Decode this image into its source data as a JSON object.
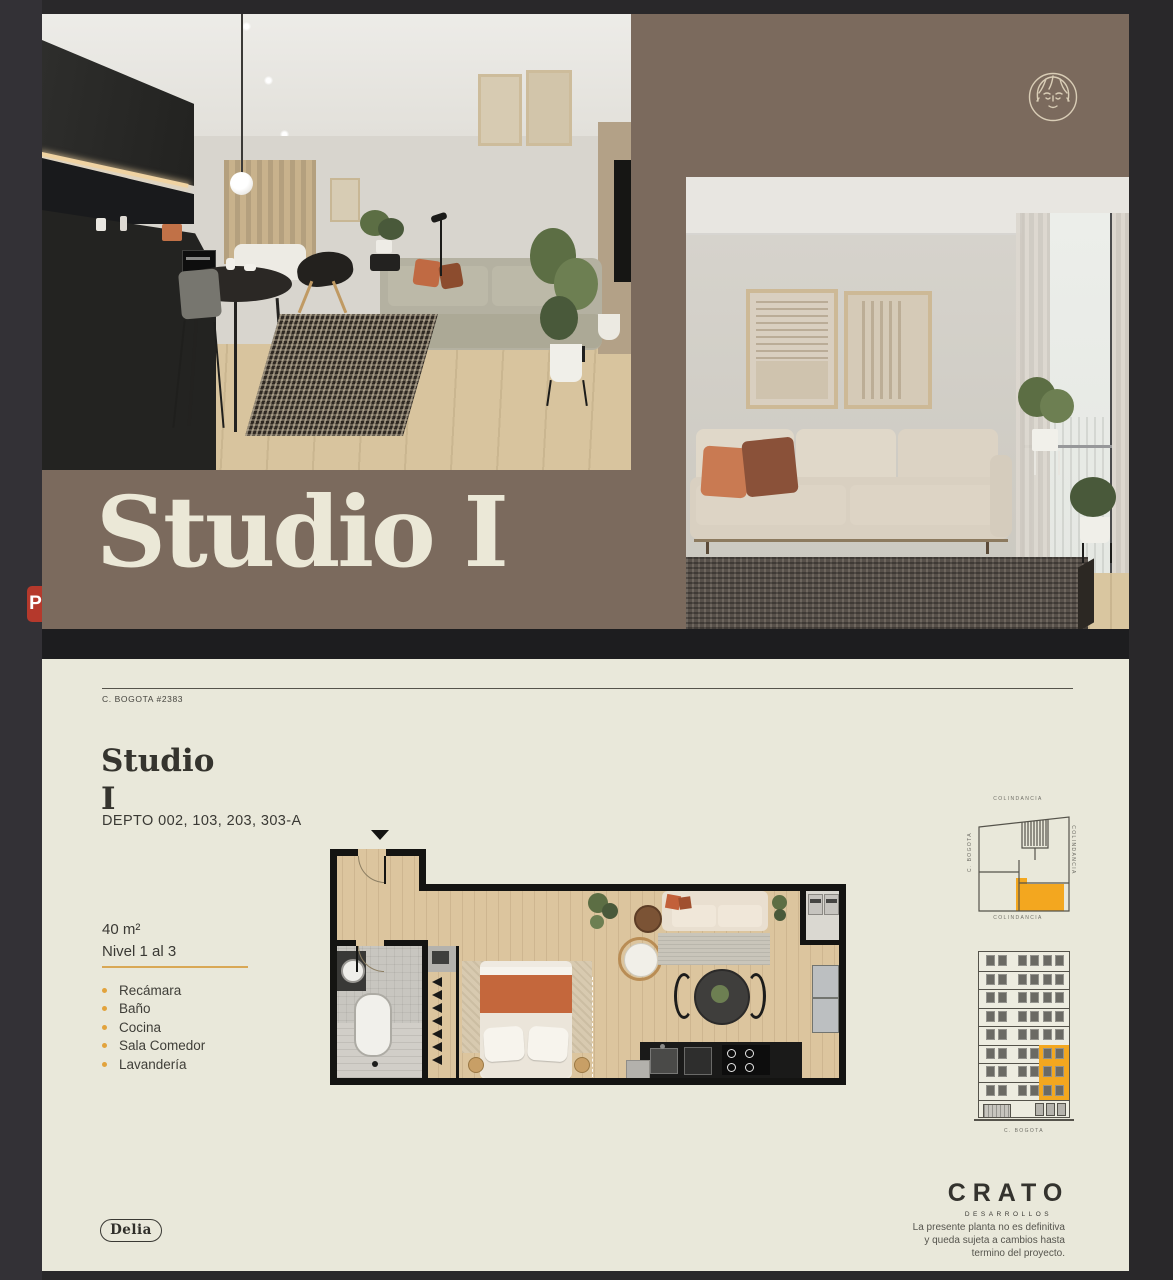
{
  "hero": {
    "title": "Studio I"
  },
  "overlay": {
    "p_badge": "P"
  },
  "sheet": {
    "address": "C. BOGOTA #2383",
    "title_line1": "Studio",
    "title_line2": "I",
    "depto": "DEPTO 002, 103, 203, 303-A",
    "area": "40 m²",
    "level": "Nivel 1 al 3",
    "features": [
      "Recámara",
      "Baño",
      "Cocina",
      "Sala Comedor",
      "Lavandería"
    ],
    "delia_badge": "Delia",
    "brand": "CRATO",
    "brand_sub": "DESARROLLOS",
    "disclaimer": "La presente planta no es definitiva\ny queda sujeta a cambios hasta\ntermino del proyecto.",
    "siteplan": {
      "label_top": "COLINDANCIA",
      "label_bottom": "COLINDANCIA",
      "label_right": "COLINDANCIA",
      "label_left": "C. BOGOTA"
    },
    "elevation": {
      "label": "C. BOGOTA",
      "floors": 9,
      "highlight_floors": [
        5,
        6,
        7
      ]
    }
  },
  "colors": {
    "surround": "#29282a",
    "hero_bg": "#7b6a5d",
    "hero_text": "#ebe8d7",
    "sheet_bg": "#e9e8da",
    "ink": "#3a3934",
    "accent": "#e2a33c",
    "plan_highlight": "#f3a71f"
  }
}
